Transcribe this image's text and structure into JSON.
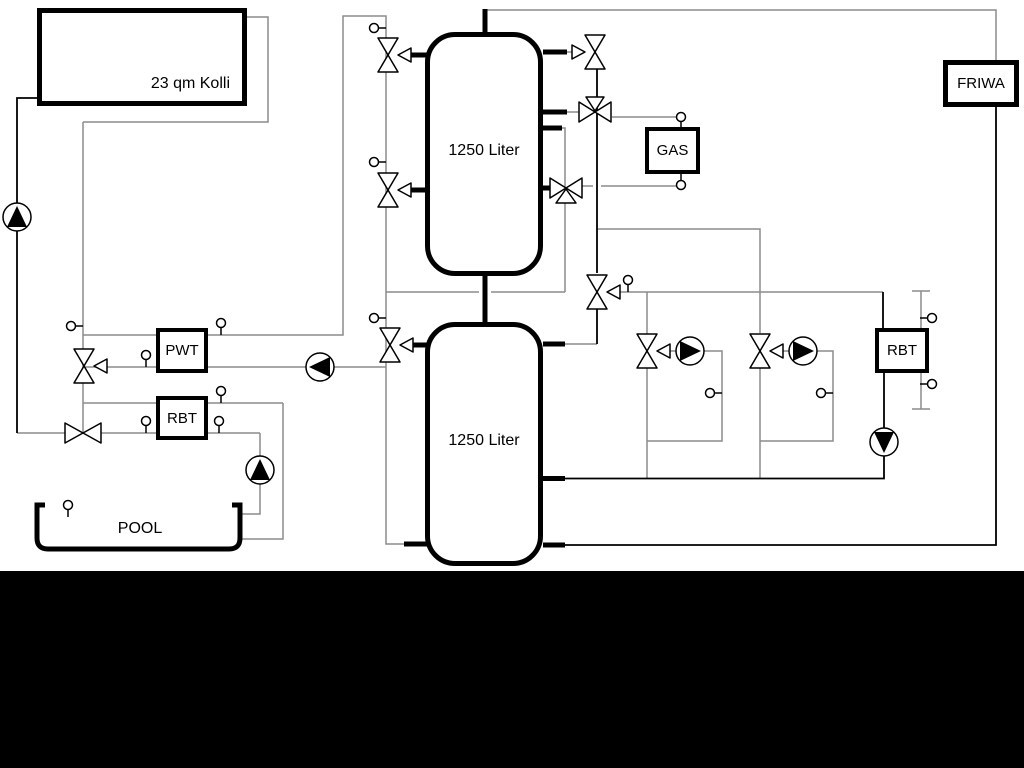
{
  "labels": {
    "collector": "23 qm Kolli",
    "tank_top": "1250 Liter",
    "tank_bottom": "1250 Liter",
    "gas": "GAS",
    "friwa": "FRIWA",
    "pwt": "PWT",
    "rbt_pool": "RBT",
    "rbt_heating": "RBT",
    "pool": "POOL"
  },
  "colors": {
    "background": "#ffffff",
    "line_black": "#000000",
    "pipe_gray": "#8c8c8c",
    "bottom_band": "#000000"
  }
}
